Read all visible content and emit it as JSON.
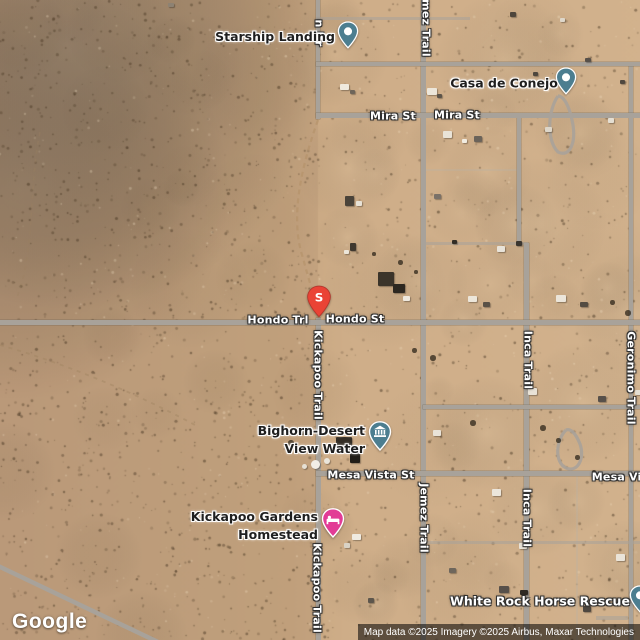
{
  "app": {
    "logo": "Google",
    "attribution": "Map data ©2025 Imagery ©2025 Airbus, Maxar Technologies"
  },
  "marker": {
    "letter": "S",
    "color": "#EA4335"
  },
  "pois": [
    {
      "name": "Starship Landing",
      "pin": "dot"
    },
    {
      "name": "Casa de Conejo",
      "pin": "dot"
    },
    {
      "name": "Bighorn-Desert View Water",
      "line1": "Bighorn-Desert",
      "line2": "View Water",
      "pin": "water-utility"
    },
    {
      "name": "Kickapoo Gardens Homestead",
      "line1": "Kickapoo Gardens",
      "line2": "Homestead",
      "pin": "lodging"
    },
    {
      "name": "White Rock Horse Rescue",
      "pin": "dot"
    }
  ],
  "roads": {
    "horizontal": [
      "Mira St",
      "Mira St",
      "Hondo Trl",
      "Hondo St",
      "Mesa Vista St",
      "Mesa Vis"
    ],
    "vertical": [
      "n Dr",
      "mez Trail",
      "Kickapoo Trail",
      "Jemez Trail",
      "Inca Trail",
      "Geronimo Trail",
      "Inca Trail",
      "Kickapoo Trail"
    ]
  },
  "colors": {
    "desert_base": "#c9a781",
    "road_gray": "#a8a29a",
    "pin_teal": "#4c7e90",
    "pin_pink": "#e23c96",
    "pin_red": "#EA4335"
  }
}
